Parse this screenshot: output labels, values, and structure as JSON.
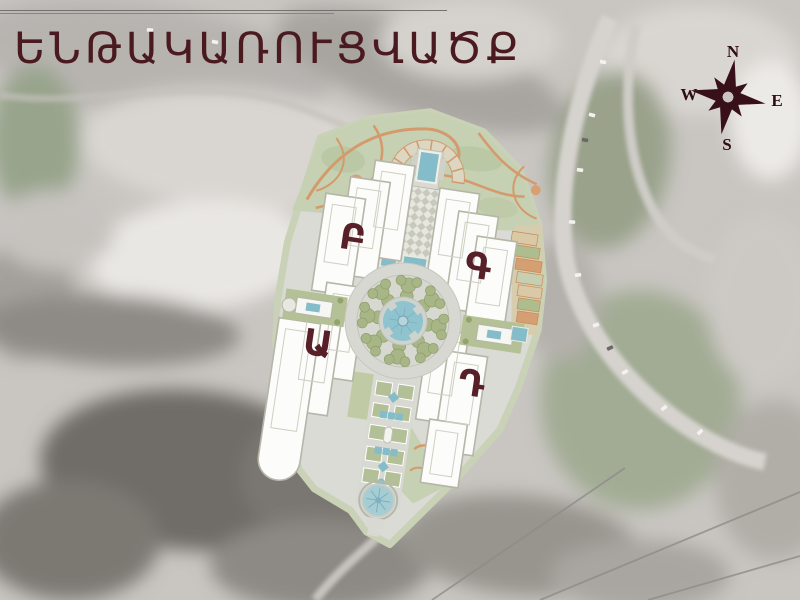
{
  "slide": {
    "title": "ԵՆԹԱԿԱՌՈՒՑՎԱԾՔ"
  },
  "compass": {
    "n": "N",
    "e": "E",
    "s": "S",
    "w": "W"
  },
  "site_plan": {
    "buildings": [
      {
        "key": "a",
        "label": "Ա"
      },
      {
        "key": "b",
        "label": "Բ"
      },
      {
        "key": "g",
        "label": "Գ"
      },
      {
        "key": "d",
        "label": "Դ"
      }
    ]
  },
  "colors": {
    "title_text": "#4a1a20",
    "building_label": "#571f27",
    "compass": "#38101a",
    "plan_water": "#85bcc9",
    "plan_green": "#c6d0b2",
    "plan_path_orange": "#d49a6b",
    "plan_building": "#fcfcfa",
    "plan_base": "#dadbd4"
  }
}
